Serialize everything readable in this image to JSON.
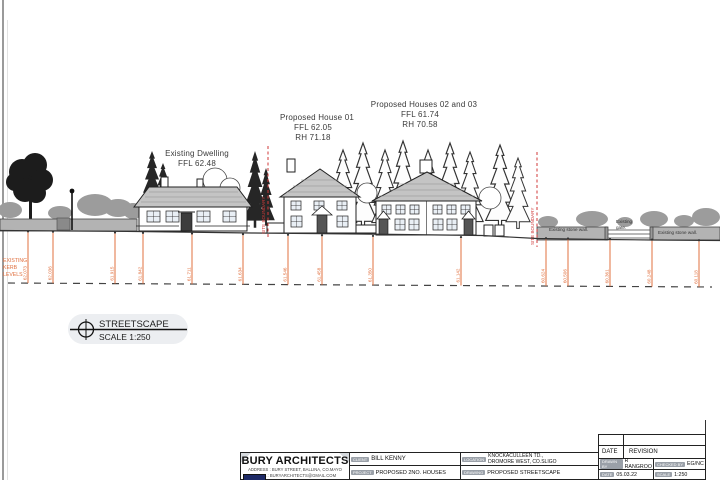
{
  "annotations": {
    "existing": {
      "title": "Existing Dwelling",
      "ffl": "FFL 62.48"
    },
    "house01": {
      "title": "Proposed House 01",
      "ffl": "FFL 62.05",
      "rh": "RH  71.18"
    },
    "houses0203": {
      "title": "Proposed Houses 02 and 03",
      "ffl": "FFL 61.74",
      "rh": "RH  70.58"
    }
  },
  "boundary": {
    "label": "SITE BOUNDARY"
  },
  "kerb": {
    "heading1": "EXISTING",
    "heading2": "KERB",
    "heading3": "LEVELS",
    "markers": [
      {
        "x": 28,
        "value": "62.073"
      },
      {
        "x": 53,
        "value": "62.036"
      },
      {
        "x": 115,
        "value": "61.915"
      },
      {
        "x": 143,
        "value": "61.842"
      },
      {
        "x": 192,
        "value": "61.711"
      },
      {
        "x": 243,
        "value": "61.634"
      },
      {
        "x": 288,
        "value": "61.546"
      },
      {
        "x": 322,
        "value": "61.458"
      },
      {
        "x": 373,
        "value": "61.350"
      },
      {
        "x": 461,
        "value": "61.142"
      },
      {
        "x": 546,
        "value": "60.624"
      },
      {
        "x": 568,
        "value": "60.506"
      },
      {
        "x": 610,
        "value": "60.361"
      },
      {
        "x": 652,
        "value": "60.248"
      },
      {
        "x": 699,
        "value": "60.118"
      }
    ]
  },
  "walls": {
    "left_label": "Existing stone wall.",
    "gate_label_1": "Existing",
    "gate_label_2": "gate.",
    "right_label": "Existing stone wall."
  },
  "emblem": {
    "title": "STREETSCAPE",
    "scale": "SCALE 1:250"
  },
  "titleblock": {
    "firm": "BURY ARCHITECTS",
    "address": "ADDRESS : BURY STREET, BALLINA, CO.MAYO",
    "email": "EMAIL : BURYARCHITECTS@GMAIL.COM",
    "client_label": "CLIENT",
    "client": "BILL KENNY",
    "project_label": "PROJECT",
    "project": "PROPOSED 2NO. HOUSES",
    "location_label": "LOCATION",
    "location_line1": "KNOCKACULLEEN TD.,",
    "location_line2": "DROMORE WEST, CO.SLIGO",
    "drawing_label": "DRAWING",
    "drawing": "PROPOSED STREETSCAPE",
    "date_label": "DATE",
    "revision_label": "REVISION",
    "drawn_label": "DRAWN BY",
    "drawn": "R RANGROO",
    "checked_label": "CHECKED BY",
    "checked": "EG/NC",
    "date2_label": "DATE",
    "date_value": "05.03.22",
    "scale_label": "SCALE",
    "scale_value": "1:250"
  },
  "colors": {
    "marker_orange": "#e0703f",
    "boundary_red": "#d03a3a",
    "roof_grey": "#c4c4c4",
    "logo_navy": "#1e2a66"
  }
}
